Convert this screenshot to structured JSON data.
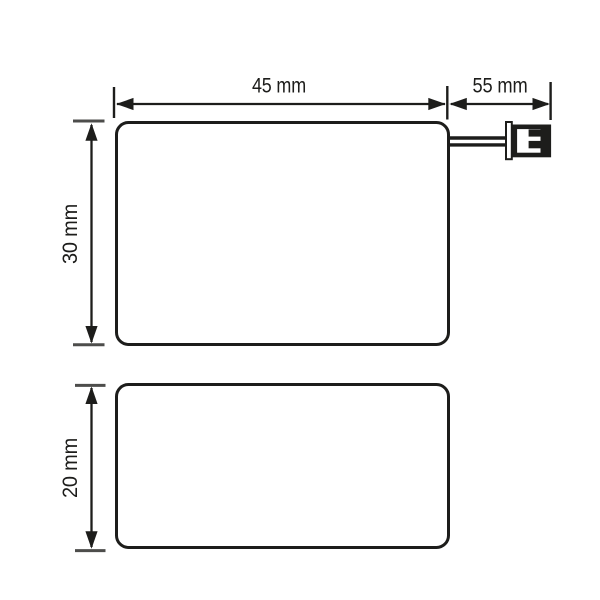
{
  "drawing": {
    "front_view": {
      "width_label": "45 mm",
      "cable_label": "55 mm",
      "height_label": "30 mm"
    },
    "side_view": {
      "height_label": "20 mm"
    },
    "colors": {
      "line": "#1d1d1b",
      "tick": "#4d4d4b",
      "background": "#ffffff"
    }
  }
}
